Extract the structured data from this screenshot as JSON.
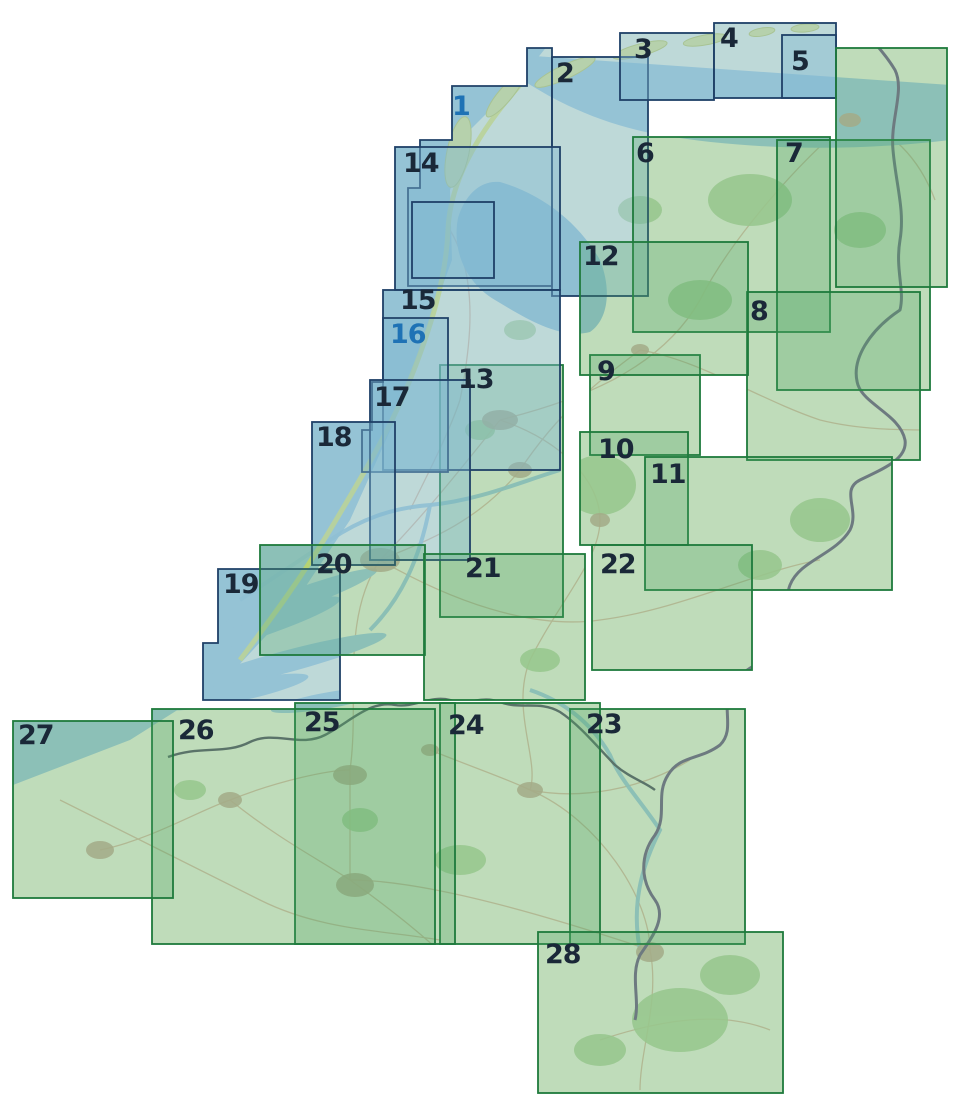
{
  "canvas": {
    "width": 960,
    "height": 1108
  },
  "map_title": "Sheet index map of the Netherlands and Flanders, numbered sheets 1-28",
  "colors": {
    "background": "#ffffff",
    "sea": "#a6cbd8",
    "land": "#ecf1dd",
    "forest": "#b4d39e",
    "dune": "#e5e570",
    "island_fill": "#dfe491",
    "island_stroke": "#c6cc67",
    "river": "#9dc6d6",
    "road": "#cda184",
    "city": "#c5ae97",
    "border_germany": "#7b6a8c",
    "border_belgium": "#60606c",
    "label_dark": "#1a2838",
    "label_blue": "#1e72b5"
  },
  "series": {
    "blue": {
      "stroke": "#1f4067",
      "fill": "rgba(127,183,210,0.42)"
    },
    "green": {
      "stroke": "#1e7a3c",
      "fill": "rgba(74,166,96,0.28)"
    }
  },
  "sheets": [
    {
      "label": "1",
      "series": "blue",
      "blue_label": true,
      "poly": [
        [
          527,
          48
        ],
        [
          552,
          48
        ],
        [
          552,
          286
        ],
        [
          408,
          286
        ],
        [
          408,
          188
        ],
        [
          420,
          188
        ],
        [
          420,
          140
        ],
        [
          452,
          140
        ],
        [
          452,
          86
        ],
        [
          527,
          86
        ]
      ],
      "label_x": 452,
      "label_y": 93
    },
    {
      "label": "2",
      "series": "blue",
      "x": 552,
      "y": 57,
      "w": 96,
      "h": 239,
      "label_x": 556,
      "label_y": 60
    },
    {
      "label": "3",
      "series": "blue",
      "x": 620,
      "y": 33,
      "w": 94,
      "h": 67,
      "label_x": 634,
      "label_y": 36
    },
    {
      "label": "4",
      "series": "blue",
      "x": 714,
      "y": 23,
      "w": 122,
      "h": 75,
      "label_x": 720,
      "label_y": 25
    },
    {
      "label": "5",
      "series": "blue",
      "x": 782,
      "y": 35,
      "w": 54,
      "h": 63,
      "label_x": 791,
      "label_y": 48
    },
    {
      "label": "6",
      "series": "green",
      "x": 633,
      "y": 137,
      "w": 197,
      "h": 195,
      "label_x": 636,
      "label_y": 140
    },
    {
      "label": "7",
      "series": "green",
      "x": 777,
      "y": 140,
      "w": 153,
      "h": 250,
      "label_x": 785,
      "label_y": 140
    },
    {
      "label": "8",
      "series": "green",
      "x": 747,
      "y": 292,
      "w": 173,
      "h": 168,
      "label_x": 750,
      "label_y": 298
    },
    {
      "label": "9",
      "series": "green",
      "x": 590,
      "y": 355,
      "w": 110,
      "h": 100,
      "label_x": 597,
      "label_y": 358
    },
    {
      "label": "10",
      "series": "green",
      "x": 580,
      "y": 432,
      "w": 108,
      "h": 113,
      "label_x": 598,
      "label_y": 436
    },
    {
      "label": "11",
      "series": "green",
      "x": 645,
      "y": 457,
      "w": 247,
      "h": 133,
      "label_x": 650,
      "label_y": 461
    },
    {
      "label": "12",
      "series": "green",
      "x": 580,
      "y": 242,
      "w": 168,
      "h": 133,
      "label_x": 583,
      "label_y": 243
    },
    {
      "label": "13",
      "series": "green",
      "x": 440,
      "y": 365,
      "w": 123,
      "h": 252,
      "label_x": 458,
      "label_y": 366
    },
    {
      "label": "14",
      "series": "blue",
      "x": 395,
      "y": 147,
      "w": 165,
      "h": 143,
      "label_x": 403,
      "label_y": 150
    },
    {
      "label": "15",
      "series": "blue",
      "x": 383,
      "y": 290,
      "w": 177,
      "h": 180,
      "label_x": 400,
      "label_y": 287
    },
    {
      "label": "16",
      "series": "blue",
      "blue_label": true,
      "poly": [
        [
          383,
          318
        ],
        [
          448,
          318
        ],
        [
          448,
          472
        ],
        [
          362,
          472
        ],
        [
          362,
          430
        ],
        [
          372,
          430
        ],
        [
          372,
          382
        ],
        [
          383,
          382
        ]
      ],
      "label_x": 390,
      "label_y": 321
    },
    {
      "label": "17",
      "series": "blue",
      "x": 370,
      "y": 380,
      "w": 100,
      "h": 180,
      "label_x": 374,
      "label_y": 384
    },
    {
      "label": "18",
      "series": "blue",
      "x": 312,
      "y": 422,
      "w": 83,
      "h": 143,
      "label_x": 316,
      "label_y": 424
    },
    {
      "label": "19",
      "series": "blue",
      "poly": [
        [
          218,
          569
        ],
        [
          340,
          569
        ],
        [
          340,
          700
        ],
        [
          203,
          700
        ],
        [
          203,
          643
        ],
        [
          218,
          643
        ]
      ],
      "label_x": 223,
      "label_y": 571
    },
    {
      "label": "20",
      "series": "green",
      "x": 260,
      "y": 545,
      "w": 165,
      "h": 110,
      "label_x": 316,
      "label_y": 551
    },
    {
      "label": "21",
      "series": "green",
      "x": 424,
      "y": 554,
      "w": 161,
      "h": 146,
      "label_x": 465,
      "label_y": 555
    },
    {
      "label": "22",
      "series": "green",
      "x": 592,
      "y": 545,
      "w": 160,
      "h": 125,
      "label_x": 600,
      "label_y": 551
    },
    {
      "label": "23",
      "series": "green",
      "x": 570,
      "y": 709,
      "w": 175,
      "h": 235,
      "label_x": 586,
      "label_y": 711
    },
    {
      "label": "24",
      "series": "green",
      "x": 440,
      "y": 703,
      "w": 160,
      "h": 241,
      "label_x": 448,
      "label_y": 712
    },
    {
      "label": "25",
      "series": "green",
      "x": 295,
      "y": 703,
      "w": 160,
      "h": 241,
      "label_x": 304,
      "label_y": 709
    },
    {
      "label": "26",
      "series": "green",
      "x": 152,
      "y": 709,
      "w": 283,
      "h": 235,
      "label_x": 178,
      "label_y": 717
    },
    {
      "label": "27",
      "series": "green",
      "x": 13,
      "y": 721,
      "w": 160,
      "h": 177,
      "label_x": 18,
      "label_y": 722
    },
    {
      "label": "28",
      "series": "green",
      "x": 538,
      "y": 932,
      "w": 245,
      "h": 161,
      "label_x": 545,
      "label_y": 941
    },
    {
      "label": "",
      "series": "blue",
      "x": 412,
      "y": 202,
      "w": 82,
      "h": 76
    },
    {
      "label": "",
      "series": "green",
      "x": 836,
      "y": 48,
      "w": 111,
      "h": 239
    }
  ]
}
